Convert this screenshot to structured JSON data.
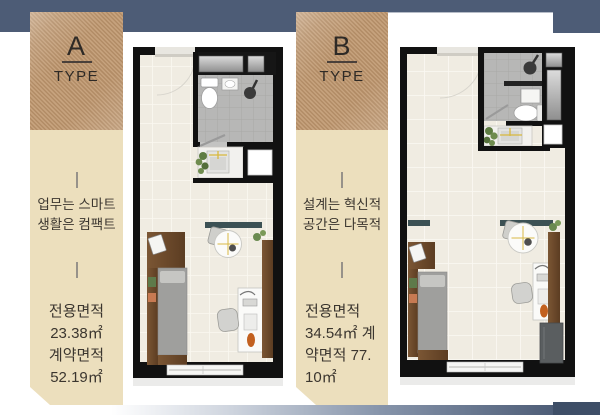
{
  "colors": {
    "header_blue": "#4d5c76",
    "footer_corner_blue": "#3e4e67",
    "type_box_tan": "#bf976e",
    "panel_beige": "#ecdfbd",
    "text_dark": "#3b362f",
    "wall_black": "#111111",
    "floor_cream": "#f0ece2",
    "bath_gray": "#b7b7b6"
  },
  "panel_a": {
    "type_letter": "A",
    "type_label": "TYPE",
    "tagline": [
      "업무는 스마트",
      "생활은 컴팩트"
    ],
    "area": [
      "전용면적",
      "23.38㎡",
      "계약면적",
      "52.19㎡"
    ]
  },
  "panel_b": {
    "type_letter": "B",
    "type_label": "TYPE",
    "tagline": [
      "설계는 혁신적",
      "공간은 다목적"
    ],
    "area": [
      "전용면적",
      "34.54㎡ 계",
      "약면적 77.",
      "10㎡"
    ]
  }
}
